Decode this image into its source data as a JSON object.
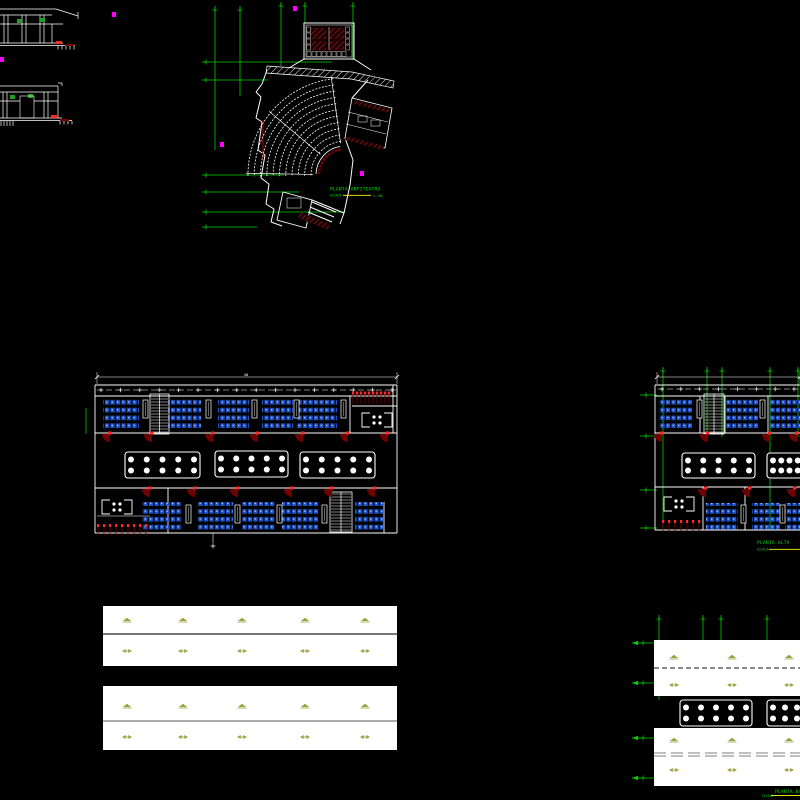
{
  "page": {
    "background": "#000000",
    "description": "CAD architectural drawing sheet"
  },
  "colors": {
    "linework": "#ffffff",
    "grid_green": "#00d000",
    "label_green": "#00dc00",
    "underline_yellow": "#ffff00",
    "desk_fill": "#2154c8",
    "desk_dot": "#c8d8ff",
    "door_swing": "#6e0000",
    "door_hinge": "#ff2828",
    "dark_red": "#7a0000",
    "bright_red": "#ff2020",
    "lamp_olive": "#9aa03c",
    "marker_magenta": "#ff00ff",
    "band_fill": "#ffffff",
    "band_divider": "#4a4a4a",
    "window_green": "#1fa01f"
  },
  "labels": {
    "auditorium": {
      "title": "PLANTA ANFITEATRO",
      "escala_label": "ESCALA",
      "scale_value": "1:100"
    },
    "upper_plan": {
      "title": "PLANTA ALTA",
      "escala_label": "ESCALA"
    },
    "lower_plan": {
      "title": "PLANTA BAJA",
      "escala_label": "ESCALA"
    }
  },
  "dimensions": {
    "upper_plan_total": "40"
  },
  "icons": {
    "ceiling_lamp": "ceiling-lamp-icon",
    "ceiling_diffuser": "ceiling-diffuser-icon",
    "door_swing": "door-swing-icon",
    "staircase": "staircase-icon",
    "lab_table": "lab-table",
    "student_desks": "student-desk-rows",
    "section_marker": "section-marker-icon",
    "restroom": "restroom-fixtures"
  }
}
